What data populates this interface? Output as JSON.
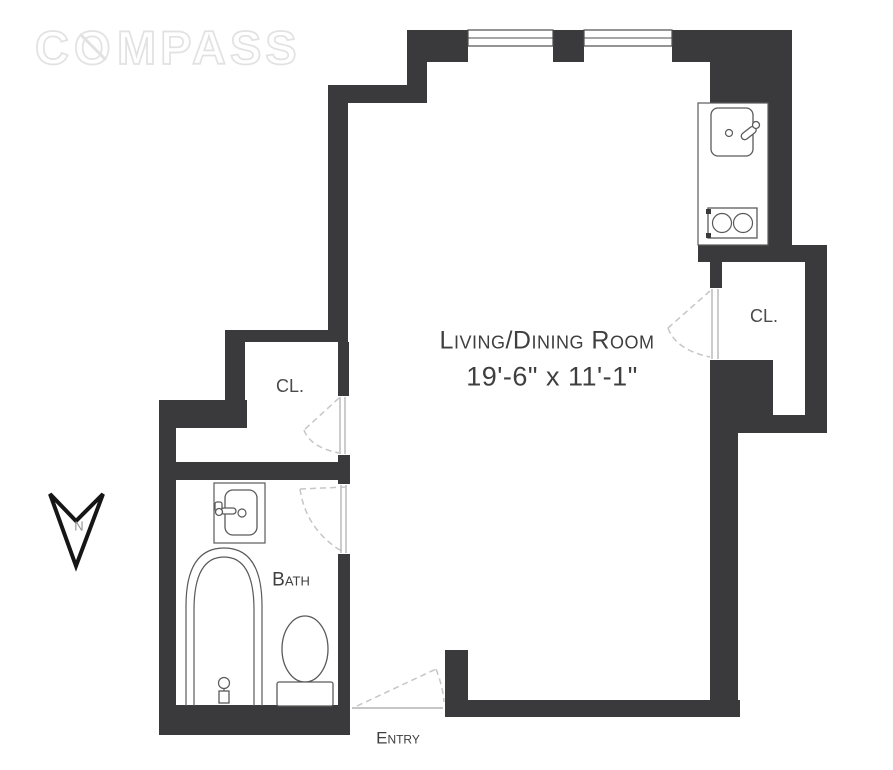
{
  "brand": {
    "c": "C",
    "o": "O",
    "rest": "MPASS"
  },
  "plan": {
    "rooms": {
      "living_dining": {
        "name": "Living/Dining Room",
        "dimensions": "19'-6\" x 11'-1\""
      },
      "bath": {
        "name": "Bath"
      },
      "closet_left": {
        "label": "CL."
      },
      "closet_right": {
        "label": "CL."
      },
      "entry": {
        "label": "Entry"
      }
    },
    "north_indicator": {
      "label": "N"
    },
    "fixtures": [
      "kitchen-sink",
      "stove",
      "bath-sink",
      "bathtub",
      "toilet"
    ],
    "window_count": 2
  },
  "colors": {
    "wall": "#3a3a3c",
    "line": "#5a5a5a",
    "dash": "#c6c6c6",
    "text": "#3f3f3f",
    "logo": "#e3e1e1"
  }
}
